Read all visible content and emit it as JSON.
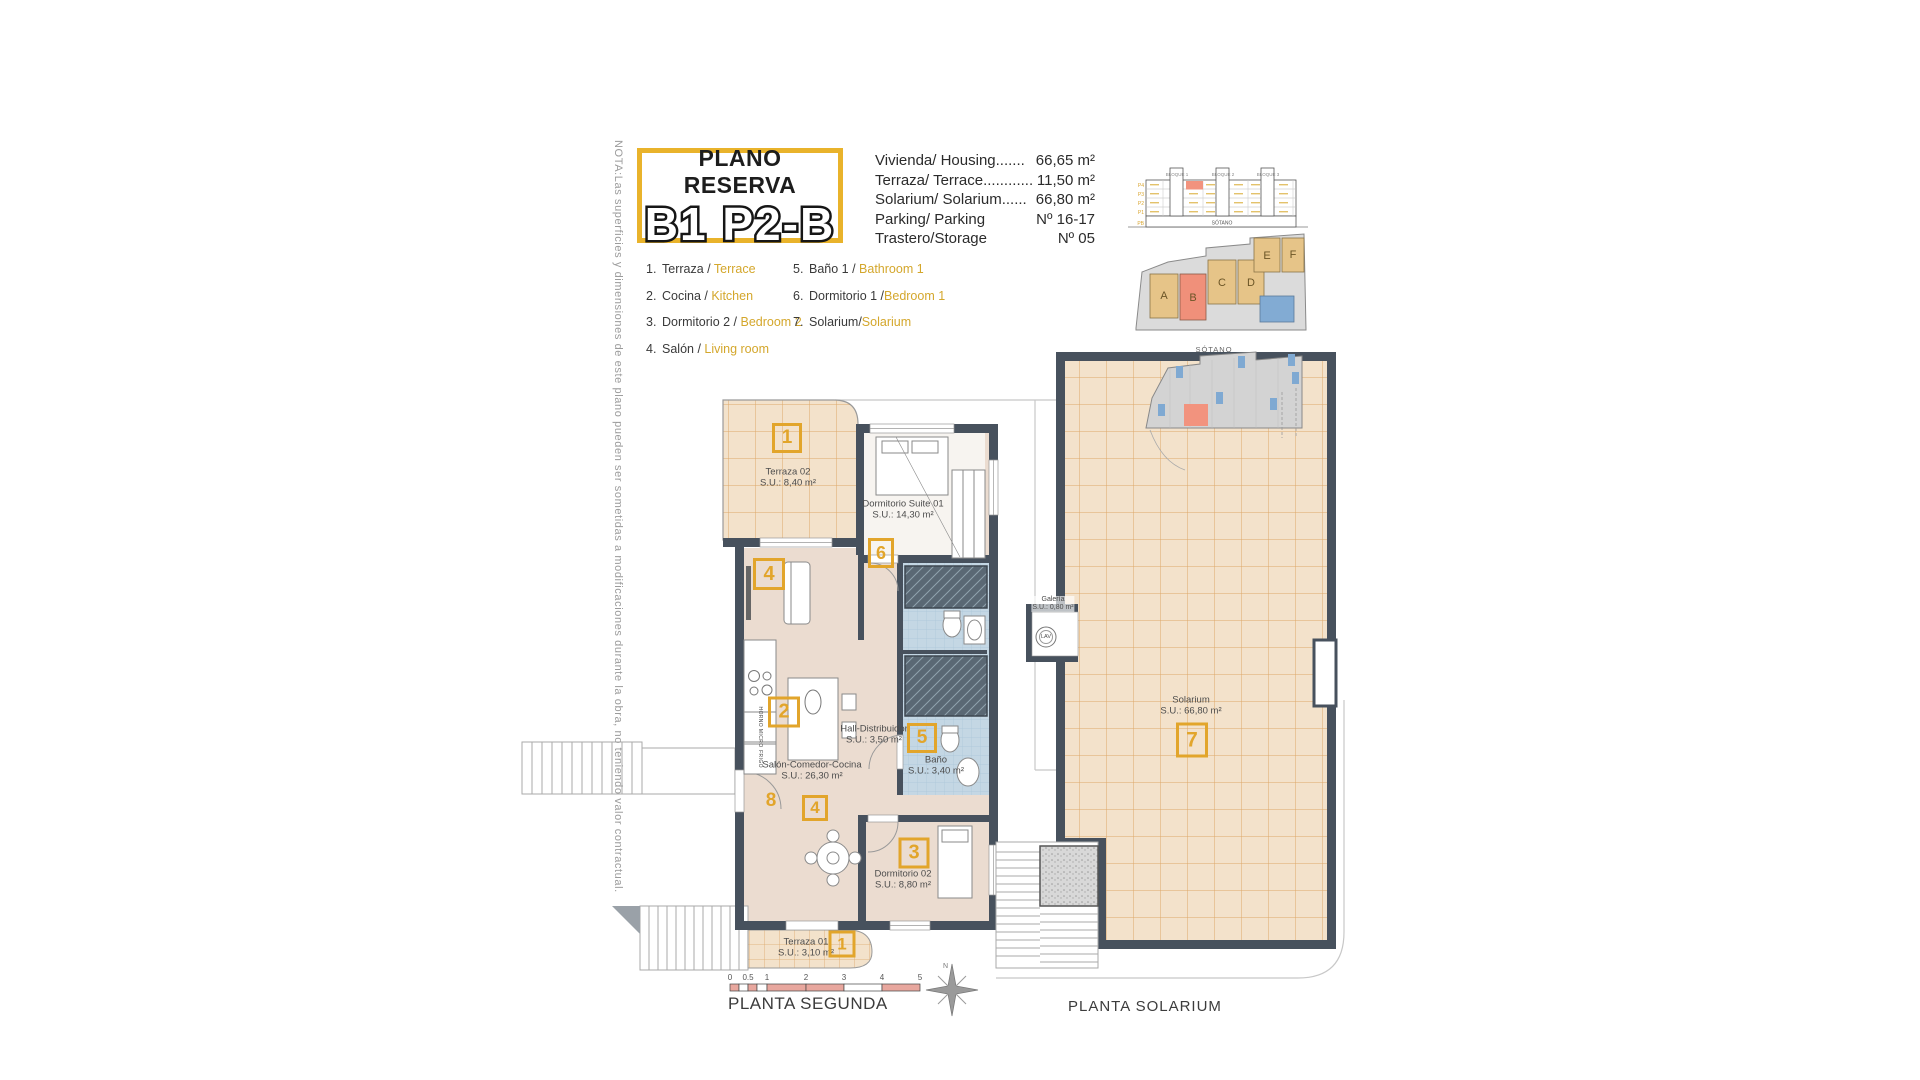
{
  "note": "NOTA:Las superficies y dimensiones de este plano pueden ser sometidas a modificaciones durante la obra, no teniendo valor contractual.",
  "title": {
    "kicker": "PLANO RESERVA",
    "code": "B1 P2-B"
  },
  "summary": [
    {
      "label": "Vivienda/ Housing.......",
      "value": "66,65 m²"
    },
    {
      "label": "Terraza/ Terrace............",
      "value": "11,50 m²"
    },
    {
      "label": "Solarium/ Solarium......",
      "value": "66,80 m²"
    },
    {
      "label": "Parking/ Parking",
      "value": "Nº 16-17"
    },
    {
      "label": "Trastero/Storage",
      "value": "Nº 05"
    }
  ],
  "legend": [
    {
      "num": "1.",
      "es": "Terraza / ",
      "en": "Terrace"
    },
    {
      "num": "2.",
      "es": "Cocina / ",
      "en": "Kitchen"
    },
    {
      "num": "3.",
      "es": "Dormitorio 2 / ",
      "en": "Bedroom 2"
    },
    {
      "num": "4.",
      "es": "Salón / ",
      "en": "Living room"
    },
    {
      "num": "5.",
      "es": "Baño 1 / ",
      "en": "Bathroom 1"
    },
    {
      "num": "6.",
      "es": "Dormitorio 1 /",
      "en": "Bedroom 1"
    },
    {
      "num": "7.",
      "es": "Solarium/",
      "en": "Solarium"
    }
  ],
  "minimap": {
    "bloque1": "BLOQUE 1",
    "bloque2": "BLOQUE 2",
    "bloque3": "BLOQUE 3",
    "floors": [
      "P4",
      "P3",
      "P2",
      "P1",
      "PB"
    ],
    "sotano_strip": "SÓTANO",
    "blocks": [
      "A",
      "B",
      "C",
      "D",
      "E",
      "F"
    ],
    "sotano_title": "SÓTANO"
  },
  "plan2": {
    "title": "PLANTA SEGUNDA",
    "rooms": {
      "terraza02": {
        "name": "Terraza 02",
        "su": "S.U.: 8,40 m²"
      },
      "suite": {
        "name": "Dormitorio Suite 01",
        "su": "S.U.: 14,30 m²"
      },
      "hall": {
        "name": "Hall-Distribuidor",
        "su": "S.U.: 3,50 m²"
      },
      "salon": {
        "name": "Salón-Comedor-Cocina",
        "su": "S.U.: 26,30 m²"
      },
      "bano": {
        "name": "Baño",
        "su": "S.U.: 3,40 m²"
      },
      "dorm02": {
        "name": "Dormitorio 02",
        "su": "S.U.: 8,80 m²"
      },
      "terraza01": {
        "name": "Terraza 01",
        "su": "S.U.: 3,10 m²"
      }
    },
    "appliances": {
      "horno": "HORNO MICRO",
      "frigo": "FRIGO"
    }
  },
  "solarium": {
    "title": "PLANTA SOLARIUM",
    "room": {
      "name": "Solarium",
      "su": "S.U.: 66,80 m²"
    },
    "galeria": {
      "name": "Galería",
      "su": "S.U.: 0,80 m²",
      "washer": "LAV"
    }
  },
  "badges": {
    "t2": "1",
    "living": "4",
    "suite": "6",
    "cocina": "2",
    "bano": "5",
    "eight": "8",
    "comedor": "4",
    "dorm2": "3",
    "t1": "1",
    "sol": "7"
  },
  "scalebar": [
    "0",
    "0.5",
    "1",
    "2",
    "3",
    "4",
    "5"
  ],
  "compass_n": "N"
}
